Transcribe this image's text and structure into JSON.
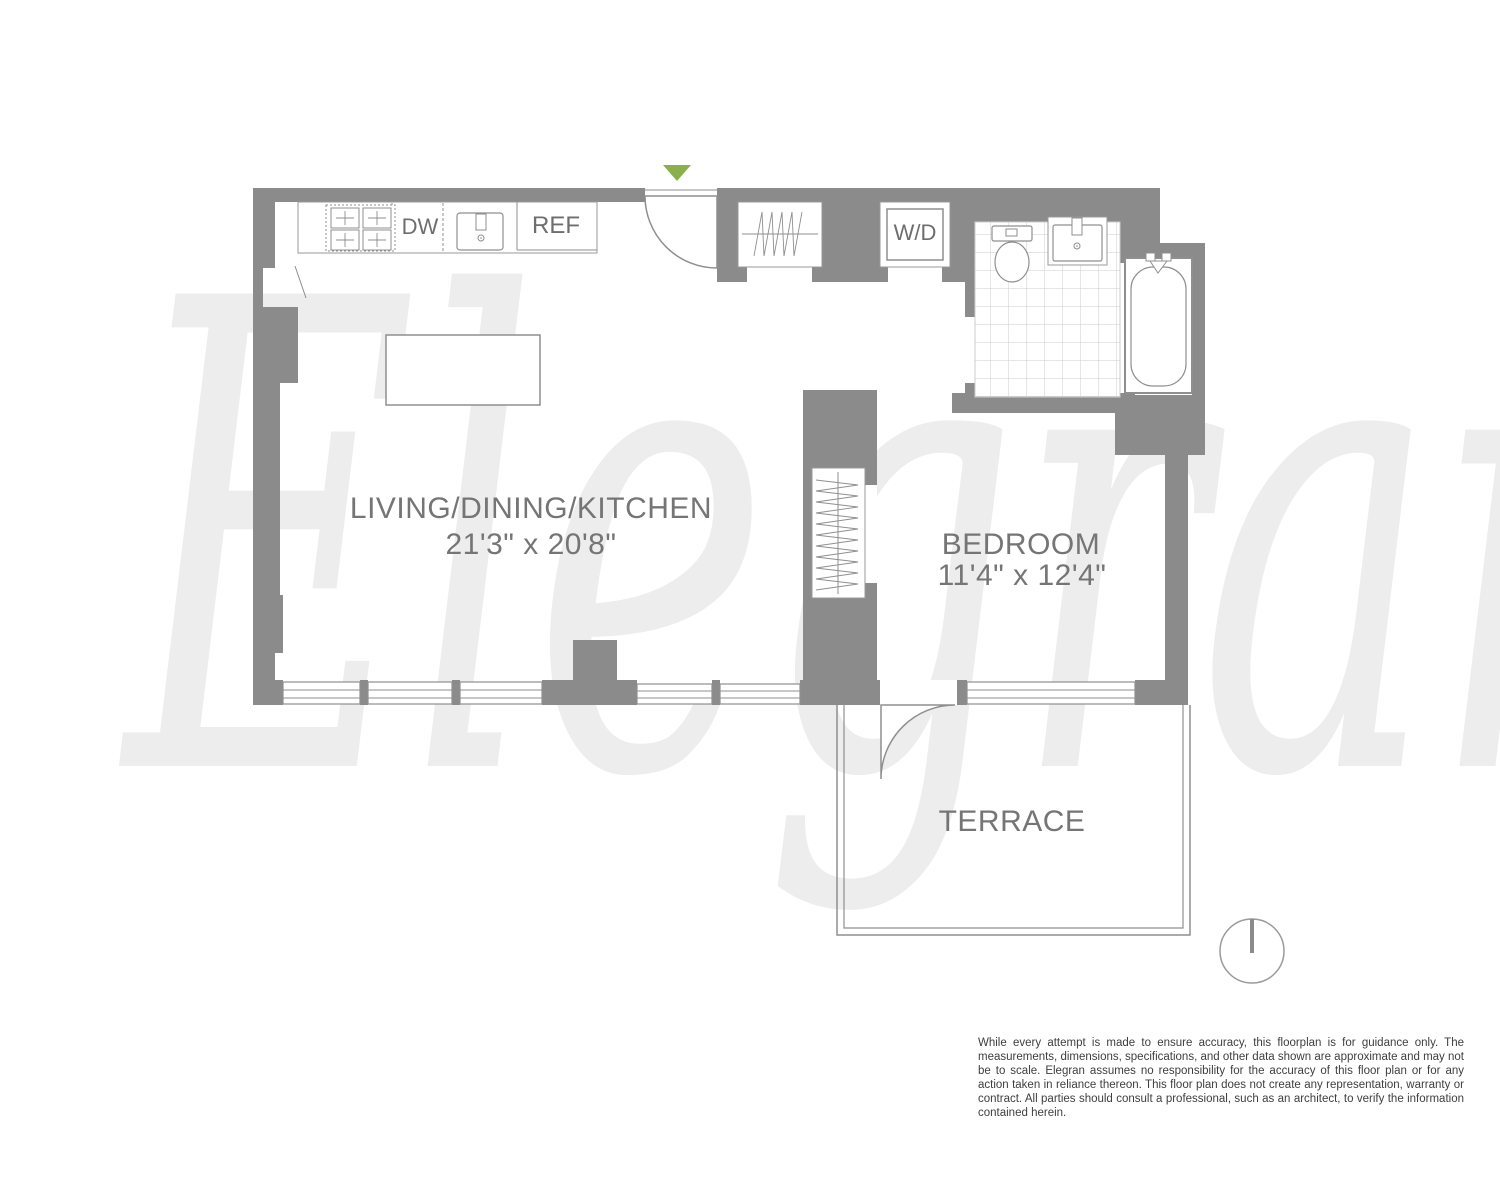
{
  "watermark_text": "Elegran",
  "rooms": {
    "living": {
      "name": "LIVING/DINING/KITCHEN",
      "dimensions": "21'3\" x 20'8\""
    },
    "bedroom": {
      "name": "BEDROOM",
      "dimensions": "11'4\" x 12'4\""
    },
    "terrace": {
      "name": "TERRACE"
    }
  },
  "kitchen": {
    "dishwasher_label": "DW",
    "refrigerator_label": "REF"
  },
  "laundry": {
    "washer_dryer_label": "W/D"
  },
  "colors": {
    "wall": "#8b8b8b",
    "fixture_line": "#8f8f8f",
    "tile_line": "#cccccc",
    "room_label": "#757575",
    "watermark": "#ededed",
    "entry_marker_green": "#8ab04b",
    "disclaimer_text": "#3e3e3e"
  },
  "disclaimer": "While every attempt is made to ensure accuracy, this floorplan is for guidance only. The measurements, dimensions, specifications, and other data shown are approximate and may not be to scale. Elegran assumes no responsibility for the accuracy of this floor plan or for any action taken in reliance thereon. This floor plan does not create any representation, warranty or contract. All parties should consult a professional, such as an architect, to verify the information contained herein."
}
